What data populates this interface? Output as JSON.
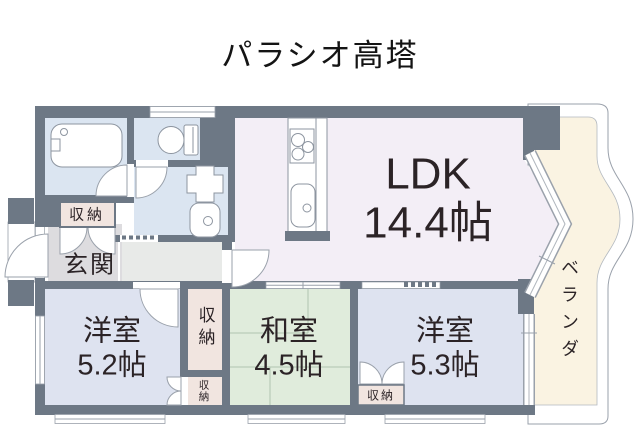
{
  "title": "パラシオ高塔",
  "rooms": {
    "ldk": {
      "name": "LDK",
      "size": "14.4帖"
    },
    "western1": {
      "name": "洋室",
      "size": "5.2帖"
    },
    "japanese": {
      "name": "和室",
      "size": "4.5帖"
    },
    "western2": {
      "name": "洋室",
      "size": "5.3帖"
    },
    "entrance": {
      "name": "玄関"
    },
    "veranda": {
      "name": "ベランダ"
    }
  },
  "storages": [
    {
      "label": "収納"
    },
    {
      "label": "収納"
    },
    {
      "label": "収納"
    },
    {
      "label": "収納"
    }
  ],
  "colors": {
    "wall": "#6d7885",
    "ldk_floor": "#f3eef6",
    "western_room_floor": "#dee3f0",
    "japanese_room_floor": "#e0ecdc",
    "sanitary_floor": "#dbe5f1",
    "hallway_floor": "#e8eae8",
    "entrance_floor": "#dddcdf",
    "storage_floor": "#f1e5e0",
    "veranda_floor": "#faf3e2",
    "outline": "#9aa1ab",
    "text": "#2b2326"
  }
}
